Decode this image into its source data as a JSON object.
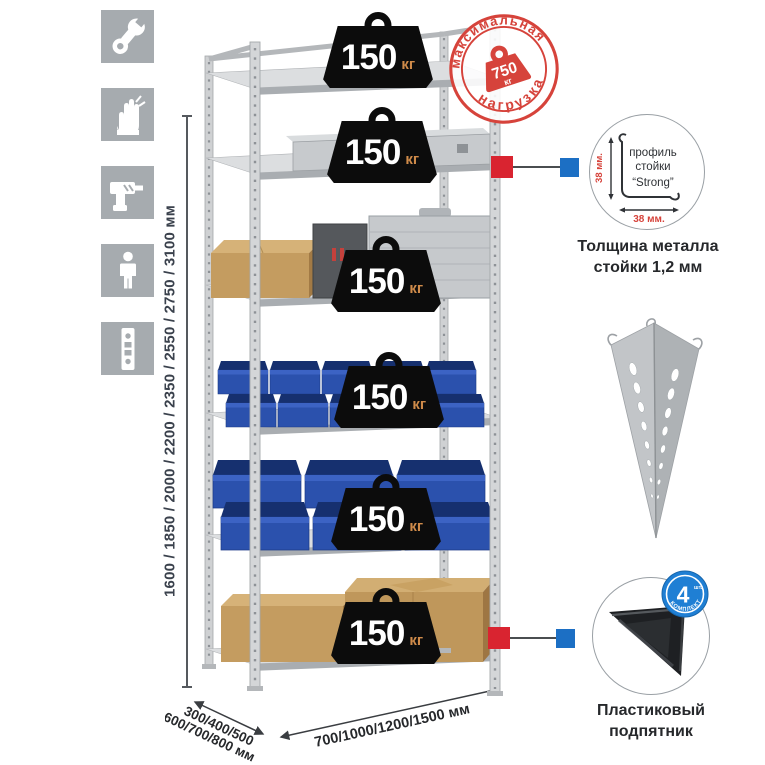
{
  "assembly_icons": [
    {
      "icon": "wrench-icon"
    },
    {
      "icon": "gloves-icon"
    },
    {
      "icon": "drill-icon"
    },
    {
      "icon": "person-icon"
    },
    {
      "icon": "upright-strip-icon"
    }
  ],
  "height_dimension": {
    "label": "1600 / 1850 / 2000 / 2200 / 2350 / 2550 / 2750 / 3100 мм"
  },
  "shelf_badges": [
    {
      "value": "150",
      "unit": "кг"
    },
    {
      "value": "150",
      "unit": "кг"
    },
    {
      "value": "150",
      "unit": "кг"
    },
    {
      "value": "150",
      "unit": "кг"
    },
    {
      "value": "150",
      "unit": "кг"
    },
    {
      "value": "150",
      "unit": "кг"
    }
  ],
  "max_load_stamp": {
    "arc_top": "максимальная",
    "arc_bottom": "нагрузка",
    "value": "750",
    "unit": "кг"
  },
  "profile_detail": {
    "label_line1": "профиль",
    "label_line2": "стойки",
    "label_line3": "“Strong”",
    "vertical_dim": "38 мм.",
    "horizontal_dim": "38 мм.",
    "caption_line1": "Толщина металла",
    "caption_line2": "стойки 1,2 мм"
  },
  "foot_detail": {
    "badge_value": "4",
    "badge_unit": "шт.",
    "badge_arc": "в комплекте",
    "caption_line1": "Пластиковый",
    "caption_line2": "подпятник"
  },
  "depth_dimension": {
    "line1": "300/400/500",
    "line2": "600/700/800 мм"
  },
  "width_dimension": {
    "label": "700/1000/1200/1500 мм"
  },
  "colors": {
    "stamp_red": "#d6433b",
    "connector_red": "#d92430",
    "connector_blue": "#1c6fc4",
    "bin_blue": "#2b51ad",
    "icon_tile_gray": "#a6abaf",
    "badge_black": "#0c0c0c",
    "unit_orange": "#cf8b4a"
  }
}
